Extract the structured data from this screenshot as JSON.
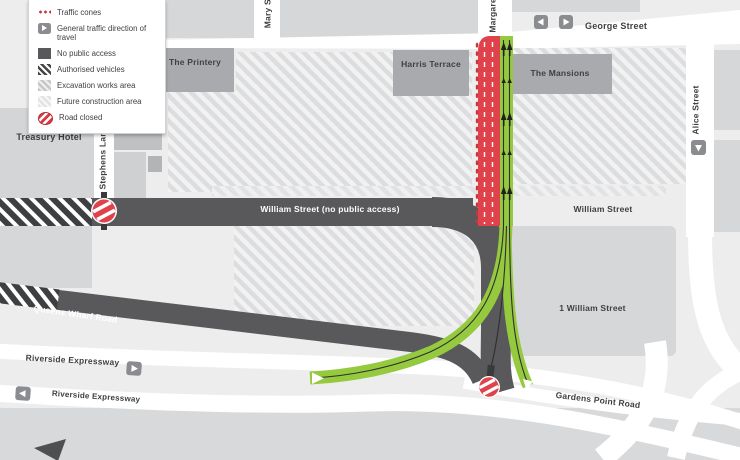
{
  "legend": {
    "items": [
      {
        "icon": "traffic-cones-icon",
        "label": "Traffic cones"
      },
      {
        "icon": "direction-arrow-icon",
        "label": "General traffic direction of travel"
      },
      {
        "icon": "no-public-access-icon",
        "label": "No public access"
      },
      {
        "icon": "authorised-vehicles-icon",
        "label": "Authorised vehicles"
      },
      {
        "icon": "excavation-works-icon",
        "label": "Excavation works area"
      },
      {
        "icon": "future-construction-icon",
        "label": "Future construction area"
      },
      {
        "icon": "road-closed-icon",
        "label": "Road closed"
      }
    ]
  },
  "streets": {
    "george": "George Street",
    "william_closed": "William Street (no public access)",
    "william_east": "William Street",
    "alice": "Alice Street",
    "stephens": "Stephens Lane",
    "mary": "Mary Street",
    "margaret": "Margaret Street",
    "queens_wharf": "Queens Wharf Road",
    "riverside_1": "Riverside Expressway",
    "riverside_2": "Riverside Expressway",
    "gardens_point": "Gardens Point Road"
  },
  "buildings": {
    "printery": "The Printery",
    "harris": "Harris Terrace",
    "mansions": "The Mansions",
    "treasury": "Treasury Hotel",
    "one_william": "1 William Street"
  },
  "colors": {
    "road_closed_red": "#e0424b",
    "open_lane_green": "#95c93e",
    "dark_road": "#59595b",
    "building_block": "#a8aaad",
    "light_block": "#d6d7d8",
    "background": "#ededee",
    "cone_red": "#c9353e",
    "text": "#3f4042"
  }
}
